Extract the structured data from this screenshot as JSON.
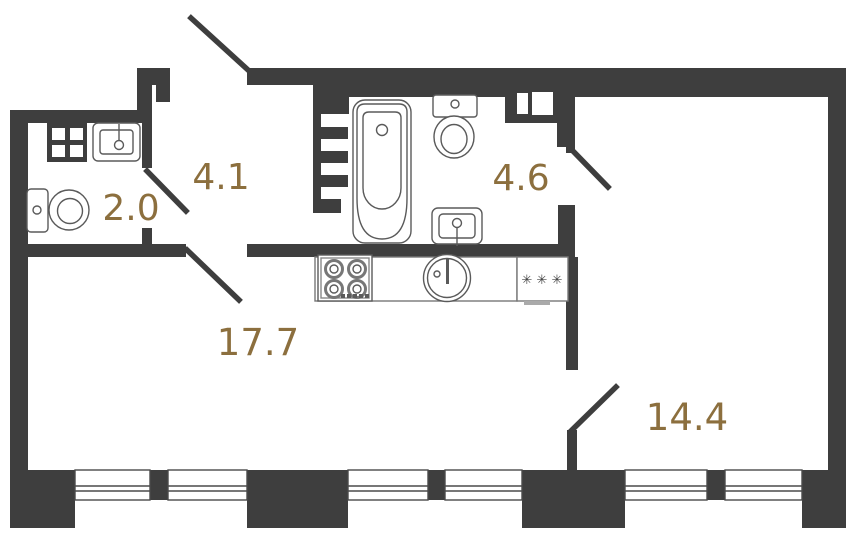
{
  "plan": {
    "rooms": {
      "wc": {
        "area": "2.0"
      },
      "hall": {
        "area": "4.1"
      },
      "bathroom": {
        "area": "4.6"
      },
      "kitchen_living": {
        "area": "17.7"
      },
      "room": {
        "area": "14.4"
      }
    },
    "fridge_marks": "✳ ✳ ✳",
    "colors": {
      "wall": "#3e3e3e",
      "room_label": "#8c6f3e",
      "fixture_line": "#5a5a5a",
      "background": "#ffffff"
    }
  }
}
